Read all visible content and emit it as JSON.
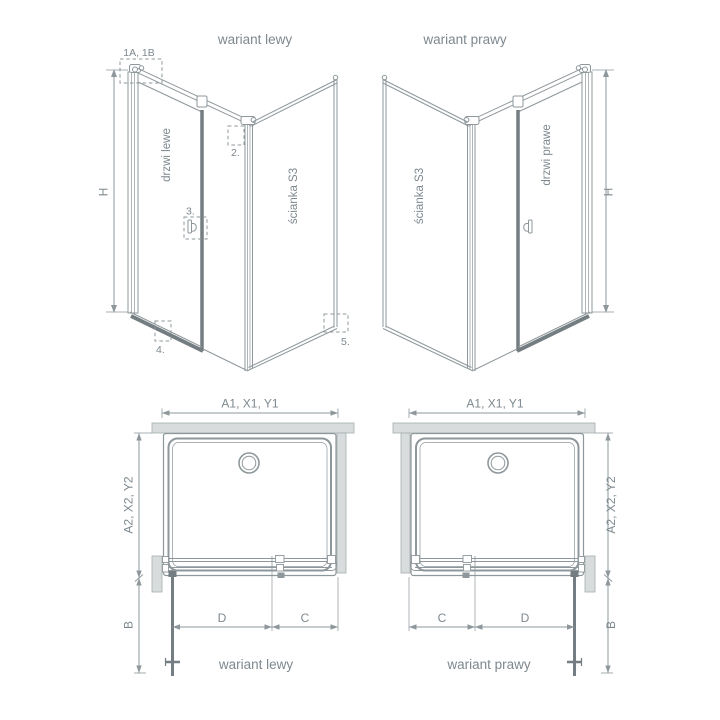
{
  "colors": {
    "line": "#8e979b",
    "dark_profile": "#747d81",
    "text": "#7d888e",
    "wall_fill": "#d9dcdd"
  },
  "left_3d": {
    "title": "wariant lewy",
    "door_label": "drzwi lewe",
    "wall_label": "ścianka S3",
    "height_label": "H",
    "marker_1": "1A, 1B",
    "marker_2": "2.",
    "marker_3": "3.",
    "marker_4": "4.",
    "marker_5": "5."
  },
  "right_3d": {
    "title": "wariant prawy",
    "door_label": "drzwi prawe",
    "wall_label": "ścianka S3",
    "height_label": "H"
  },
  "left_plan": {
    "title": "wariant lewy",
    "width_label": "A1, X1, Y1",
    "depth_label": "A2, X2, Y2",
    "b_label": "B",
    "d_label": "D",
    "c_label": "C"
  },
  "right_plan": {
    "title": "wariant prawy",
    "width_label": "A1, X1, Y1",
    "depth_label": "A2, X2, Y2",
    "b_label": "B",
    "d_label": "D",
    "c_label": "C"
  }
}
